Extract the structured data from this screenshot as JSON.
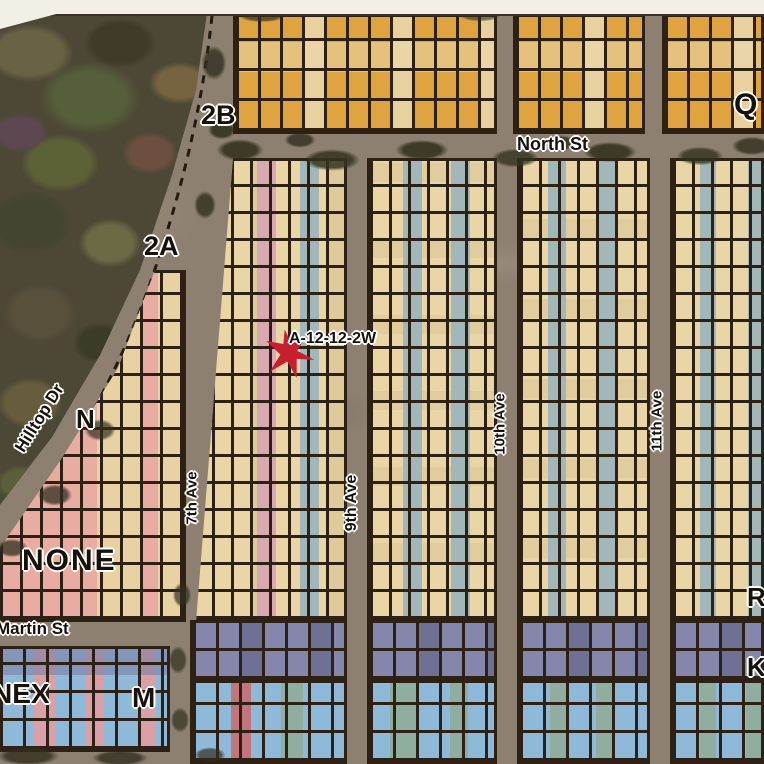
{
  "map": {
    "title": "plat map with marked lot",
    "marker": {
      "label": "A-12-12-2W"
    },
    "sections": {
      "s2b": "2B",
      "s2a": "2A",
      "q": "Q",
      "n": "N",
      "none": "NONE",
      "nex": "NEX",
      "m": "M",
      "r": "R",
      "k": "K"
    },
    "streets": {
      "north": "North St",
      "martin": "Martin St",
      "hilltop": "Hilltop Dr"
    },
    "avenues": {
      "a7": "7th Ave",
      "a9": "9th Ave",
      "a10": "10th Ave",
      "a11": "11th Ave"
    },
    "colors": {
      "marker_red": "#c6202e",
      "lot_orange": "#dfa43f",
      "lot_tan": "#e9d5a6",
      "lot_pink": "#e9aca3",
      "lot_bluegray": "#a2b7b9",
      "lot_purple": "#8486ab",
      "lot_blue": "#8fb9d9",
      "road_gray": "#8e8071",
      "grid_line": "#2c2114"
    }
  }
}
